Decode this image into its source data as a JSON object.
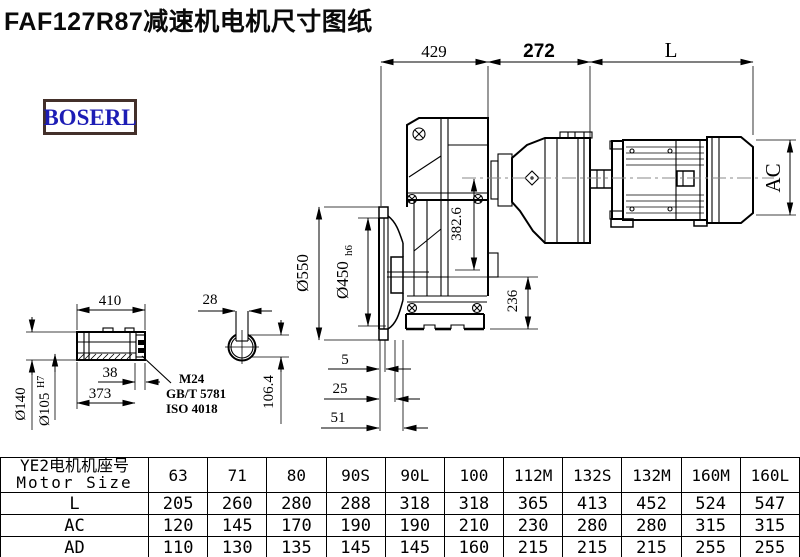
{
  "title": "FAF127R87减速机电机尺寸图纸",
  "logo": {
    "text": "BOSERL",
    "border_color": "#43302a",
    "text_color": "#1d1db5"
  },
  "colors": {
    "line": "#000000",
    "centerline": "#8a8a8a",
    "background": "#ffffff"
  },
  "dims": {
    "top_429": "429",
    "top_272": "272",
    "top_L": "L",
    "dia_550": "Ø550",
    "dia_450": "Ø450",
    "dia_450_tol": "h6",
    "height_382_6": "382.6",
    "height_236": "236",
    "flange_5": "5",
    "flange_25": "25",
    "flange_51": "51",
    "motor_ac": "AC"
  },
  "shaft": {
    "len_410": "410",
    "dia_140": "Ø140",
    "dia_105": "Ø105",
    "dia_105_tol": "H7",
    "dim_38": "38",
    "dim_373": "373",
    "thread": "M24",
    "std_gb": "GB/T 5781",
    "std_iso": "ISO 4018",
    "key_w_28": "28",
    "key_h_106_4": "106.4"
  },
  "table": {
    "header_cn": "YE2电机机座号",
    "header_en": "Motor Size",
    "columns": [
      "63",
      "71",
      "80",
      "90S",
      "90L",
      "100",
      "112M",
      "132S",
      "132M",
      "160M",
      "160L"
    ],
    "rows": [
      {
        "label": "L",
        "values": [
          "205",
          "260",
          "280",
          "288",
          "318",
          "318",
          "365",
          "413",
          "452",
          "524",
          "547"
        ]
      },
      {
        "label": "AC",
        "values": [
          "120",
          "145",
          "170",
          "190",
          "190",
          "210",
          "230",
          "280",
          "280",
          "315",
          "315"
        ]
      },
      {
        "label": "AD",
        "values": [
          "110",
          "130",
          "135",
          "145",
          "145",
          "160",
          "215",
          "215",
          "215",
          "255",
          "255"
        ]
      }
    ]
  }
}
